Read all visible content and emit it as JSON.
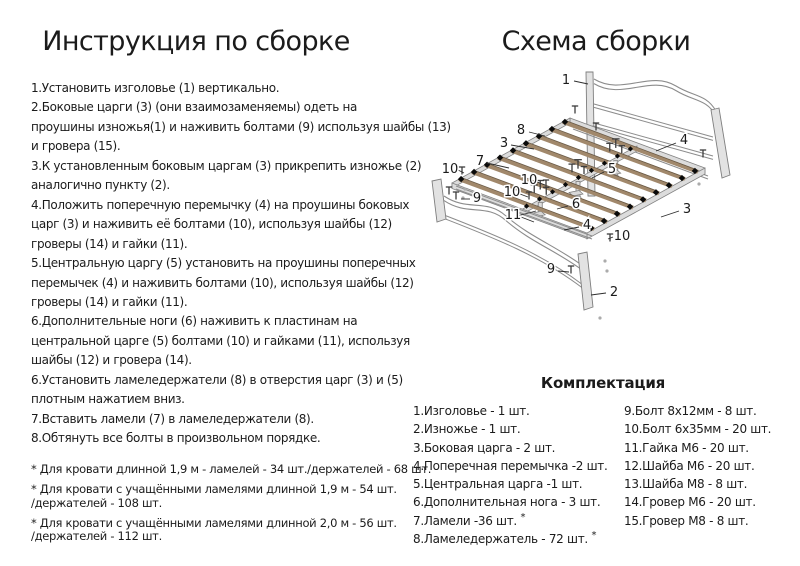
{
  "left": {
    "title": "Инструкция по сборке",
    "instruction_lines": [
      "1.Установить изголовье (1) вертикально.",
      "2.Боковые царги (3) (они взаимозаменяемы) одеть на",
      "проушины изножья(1) и наживить болтами (9) используя шайбы (13)",
      "и гровера (15).",
      "3.К установленным боковым царгам (3) прикрепить изножье (2)",
      "аналогично пункту (2).",
      "4.Положить поперечную перемычку (4) на проушины боковых",
      "царг (3) и наживить её болтами (10), используя шайбы (12)",
      "гроверы (14) и гайки (11).",
      "5.Центральную царгу (5) установить на проушины поперечных",
      "перемычек (4) и наживить болтами (10), используя шайбы (12)",
      "гроверы (14) и гайки (11).",
      "6.Дополнительные ноги (6) наживить к пластинам на",
      "центральной царге (5) болтами (10) и гайками (11), используя",
      "шайбы (12) и гровера (14).",
      "6.Установить ламеледержатели (8) в отверстия царг (3) и (5)",
      "плотным нажатием вниз.",
      "7.Вставить ламели (7) в ламеледержатели (8).",
      "8.Обтянуть все болты в произвольном порядке."
    ],
    "footnotes": [
      {
        "lines": [
          "* Для кровати длинной 1,9 м - ламелей - 34 шт./держателей - 68 шт."
        ]
      },
      {
        "lines": [
          "* Для кровати с учащёнными ламелями длинной 1,9 м - 54 шт.",
          "/держателей - 108 шт."
        ]
      },
      {
        "lines": [
          "* Для кровати с учащёнными ламелями длинной 2,0 м - 56 шт.",
          "/держателей - 112 шт."
        ]
      }
    ]
  },
  "right": {
    "title": "Схема сборки",
    "diagram": {
      "callouts": [
        "1",
        "8",
        "3",
        "7",
        "10",
        "5",
        "4",
        "10",
        "10",
        "9",
        "6",
        "11",
        "4",
        "3",
        "10",
        "9",
        "2"
      ],
      "colors": {
        "metal": "#dcdcdc",
        "metal_edge": "#828282",
        "slat": "#a1886b",
        "slat_edge": "#6a5a46",
        "clip": "#0a0a0a",
        "leader_line": "#2e2e2e",
        "callout_text": "#1b1b1b"
      }
    },
    "parts": {
      "title": "Комплектация",
      "col1": [
        {
          "label": "1.Изголовье - 1 шт."
        },
        {
          "label": "2.Изножье - 1 шт."
        },
        {
          "label": "3.Боковая царга - 2 шт."
        },
        {
          "label": "4.Поперечная перемычка -2 шт."
        },
        {
          "label": "5.Центральная царга -1 шт."
        },
        {
          "label": "6.Дополнительная нога - 3 шт."
        },
        {
          "label": "7.Ламели -36 шт.",
          "star": true
        },
        {
          "label": "8.Ламеледержатель - 72 шт.",
          "star": true
        }
      ],
      "col2": [
        {
          "label": "9.Болт 8х12мм - 8 шт."
        },
        {
          "label": "10.Болт 6х35мм - 20 шт."
        },
        {
          "label": "11.Гайка М6 - 20 шт."
        },
        {
          "label": "12.Шайба М6 - 20 шт."
        },
        {
          "label": "13.Шайба М8 - 8 шт."
        },
        {
          "label": "14.Гровер М6 - 20 шт."
        },
        {
          "label": "15.Гровер М8 - 8 шт."
        }
      ]
    }
  }
}
